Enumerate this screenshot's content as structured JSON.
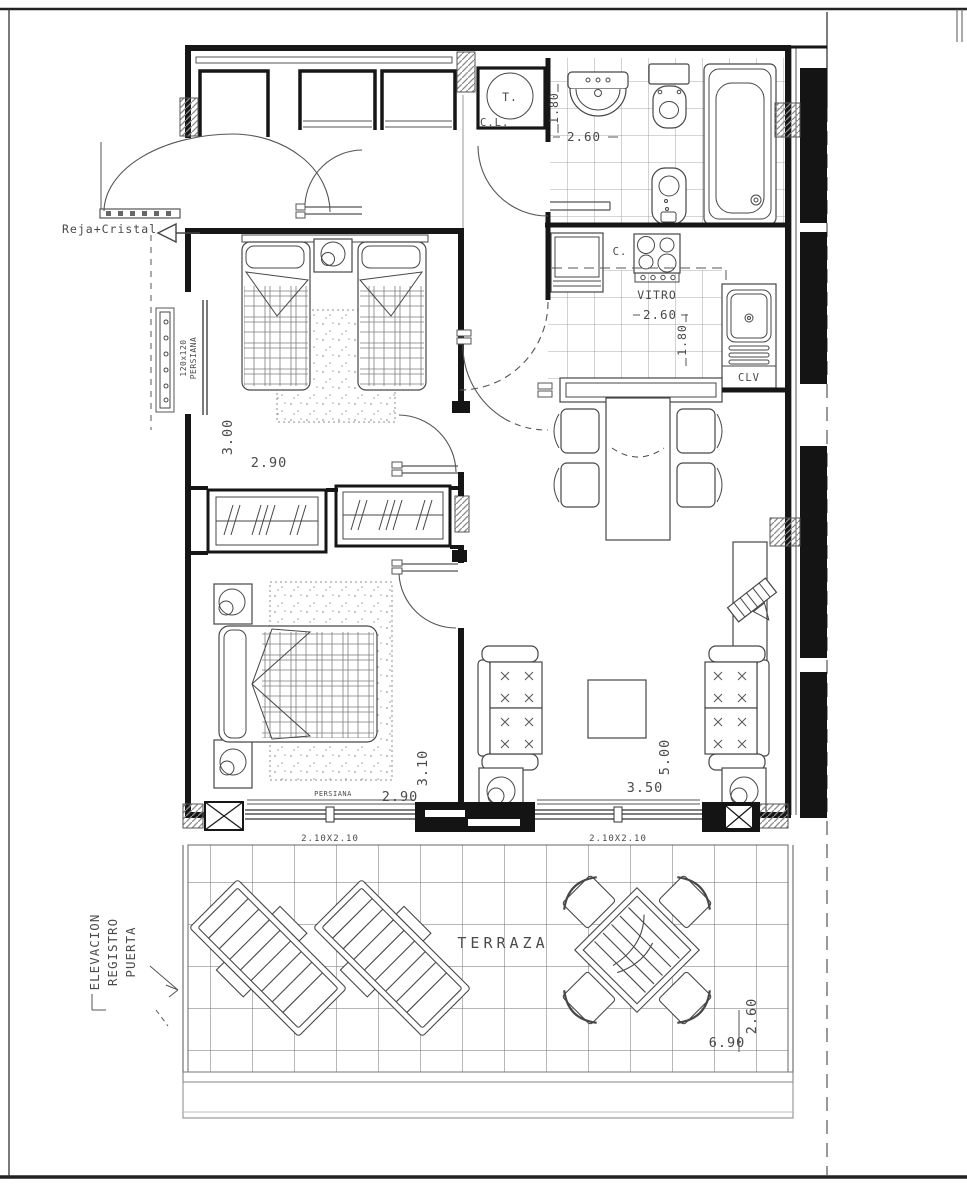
{
  "plan": {
    "annotations": {
      "reja_cristal": "Reja+Cristal",
      "elevacion_lines": [
        "ELEVACION",
        "REGISTRO",
        "PUERTA"
      ]
    },
    "hall": {
      "heater_label": "T.",
      "closet_label": "C.L."
    },
    "bathroom": {
      "width_m": "2.60",
      "depth_m": "1.80"
    },
    "kitchen": {
      "counter_label": "C.",
      "cooktop_label": "VITRO",
      "width_m": "2.60",
      "depth_m": "1.80",
      "sink_unit_label": "CLV"
    },
    "bedroom_twin": {
      "depth_m": "3.00",
      "width_m": "2.90",
      "window_size": "120x120",
      "window_type": "PERSIANA"
    },
    "bedroom_double": {
      "depth_m": "3.10",
      "width_m": "2.90",
      "blind_label": "PERSIANA",
      "window_label": "2.10X2.10"
    },
    "living_room": {
      "depth_m": "5.00",
      "width_m": "3.50",
      "window_label": "2.10X2.10"
    },
    "terrace": {
      "label": "TERRAZA",
      "width_m": "6.90",
      "depth_m": "2.60"
    }
  }
}
